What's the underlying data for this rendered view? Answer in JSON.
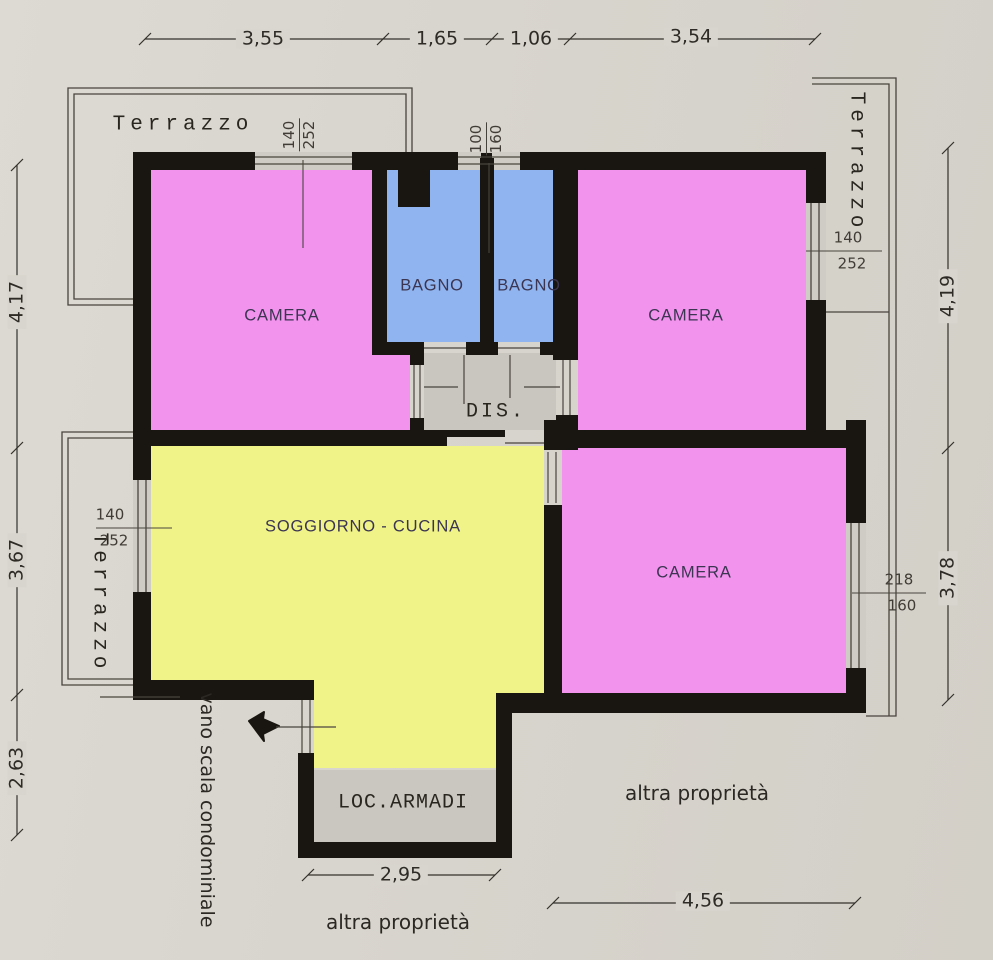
{
  "document_type": "apartment floor plan scan",
  "colors": {
    "background": "#d8d5ce",
    "wall": "#191510",
    "room_pink": "#f293ee",
    "room_blue": "#90b4ef",
    "room_yellow": "#f0f388",
    "service_gray": "#cac7c0",
    "thin_line": "#49453e"
  },
  "rooms": {
    "camera_nw": {
      "label": "CAMERA"
    },
    "bagno_left": {
      "label": "BAGNO"
    },
    "bagno_right": {
      "label": "BAGNO"
    },
    "camera_ne": {
      "label": "CAMERA"
    },
    "disimpegno": {
      "label": "DIS."
    },
    "soggiorno": {
      "label": "SOGGIORNO - CUCINA"
    },
    "camera_se": {
      "label": "CAMERA"
    },
    "loc_armadi": {
      "label": "LOC.ARMADI"
    }
  },
  "exterior": {
    "terrazzo_top_left": "Terrazzo",
    "terrazzo_top_right": "Terrazzo",
    "terrazzo_left": "Terrazzo",
    "vano_scala": "vano scala condominiale",
    "altra_proprieta_east": "altra proprietà",
    "altra_proprieta_south": "altra proprietà"
  },
  "windows": {
    "camera_nw_top": {
      "w": "140",
      "h": "252"
    },
    "bagni_top": {
      "w": "100",
      "h": "160"
    },
    "camera_ne_east": {
      "w": "140",
      "h": "252"
    },
    "soggiorno_west": {
      "w": "140",
      "h": "252"
    },
    "camera_se_east": {
      "w": "218",
      "h": "160"
    }
  },
  "dimensions": {
    "top": [
      "3,55",
      "1,65",
      "1,06",
      "3,54"
    ],
    "left": [
      "4,17",
      "3,67",
      "2,63"
    ],
    "right": [
      "4,19",
      "3,78"
    ],
    "bottom_armadi": "2,95",
    "bottom_right": "4,56"
  }
}
